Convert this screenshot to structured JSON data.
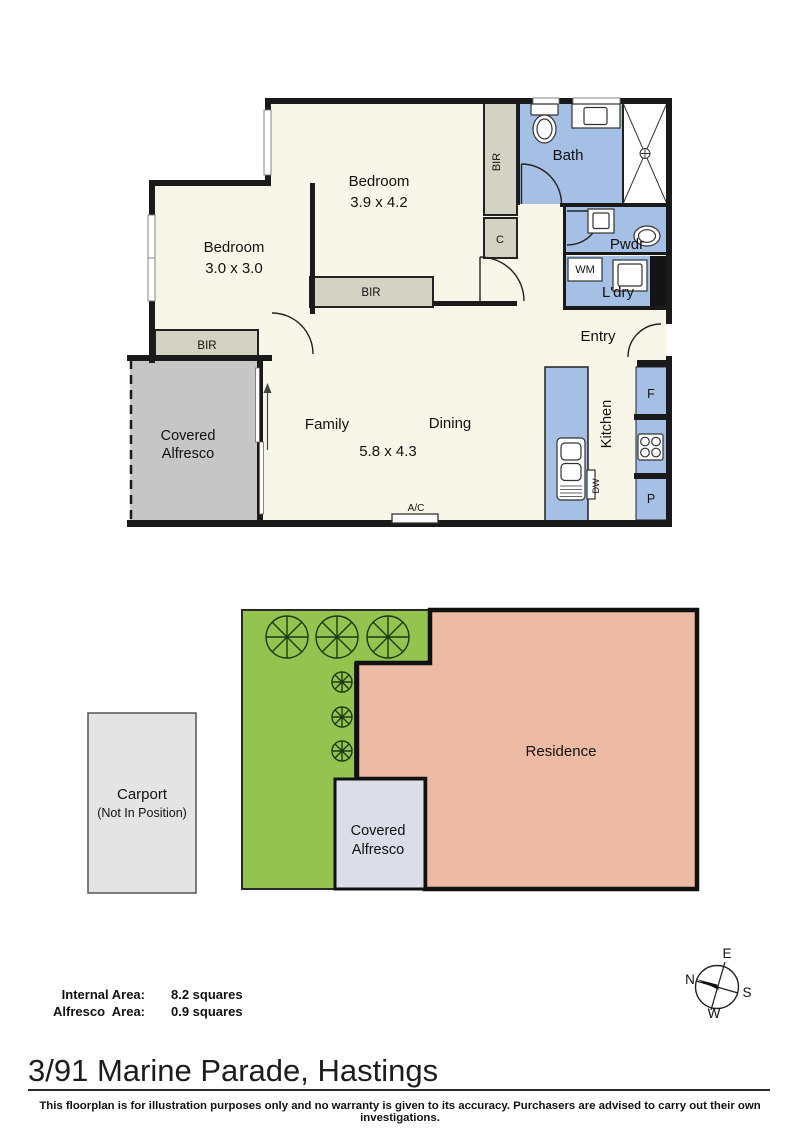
{
  "floorplan": {
    "bedroom1": {
      "name": "Bedroom",
      "dims": "3.9 x 4.2"
    },
    "bedroom2": {
      "name": "Bedroom",
      "dims": "3.0 x 3.0"
    },
    "bath": "Bath",
    "pwdr": "Pwdr",
    "ldry": "L'dry",
    "entry": "Entry",
    "family": "Family",
    "dining": "Dining",
    "family_dims": "5.8 x 4.3",
    "kitchen": "Kitchen",
    "bir": "BIR",
    "closet": "C",
    "wm": "WM",
    "dw": "DW",
    "fridge": "F",
    "pantry": "P",
    "ac": "A/C",
    "alfresco_line1": "Covered",
    "alfresco_line2": "Alfresco"
  },
  "siteplan": {
    "residence": "Residence",
    "alfresco_line1": "Covered",
    "alfresco_line2": "Alfresco",
    "carport_line1": "Carport",
    "carport_line2": "(Not In Position)"
  },
  "compass": {
    "n": "N",
    "e": "E",
    "s": "S",
    "w": "W"
  },
  "areas": {
    "internal_label": "Internal Area:",
    "internal_value": "8.2 squares",
    "alfresco_label": "Alfresco  Area:",
    "alfresco_value": "0.9 squares"
  },
  "footer": {
    "address": "3/91 Marine Parade, Hastings",
    "disclaimer": "This floorplan is for illustration purposes only and no warranty is given to its accuracy. Purchasers are advised to carry out their own investigations."
  },
  "colors": {
    "wall": "#1a1a1a",
    "floor": "#f8f6e8",
    "wet_area_blue": "#a5c0e4",
    "closet": "#d3d3c3",
    "alfresco_floor": "#c6c6c6",
    "site_green": "#94c350",
    "residence_pink": "#edbaa4",
    "site_alfresco": "#dcdde8",
    "carport": "#e4e4e4"
  }
}
